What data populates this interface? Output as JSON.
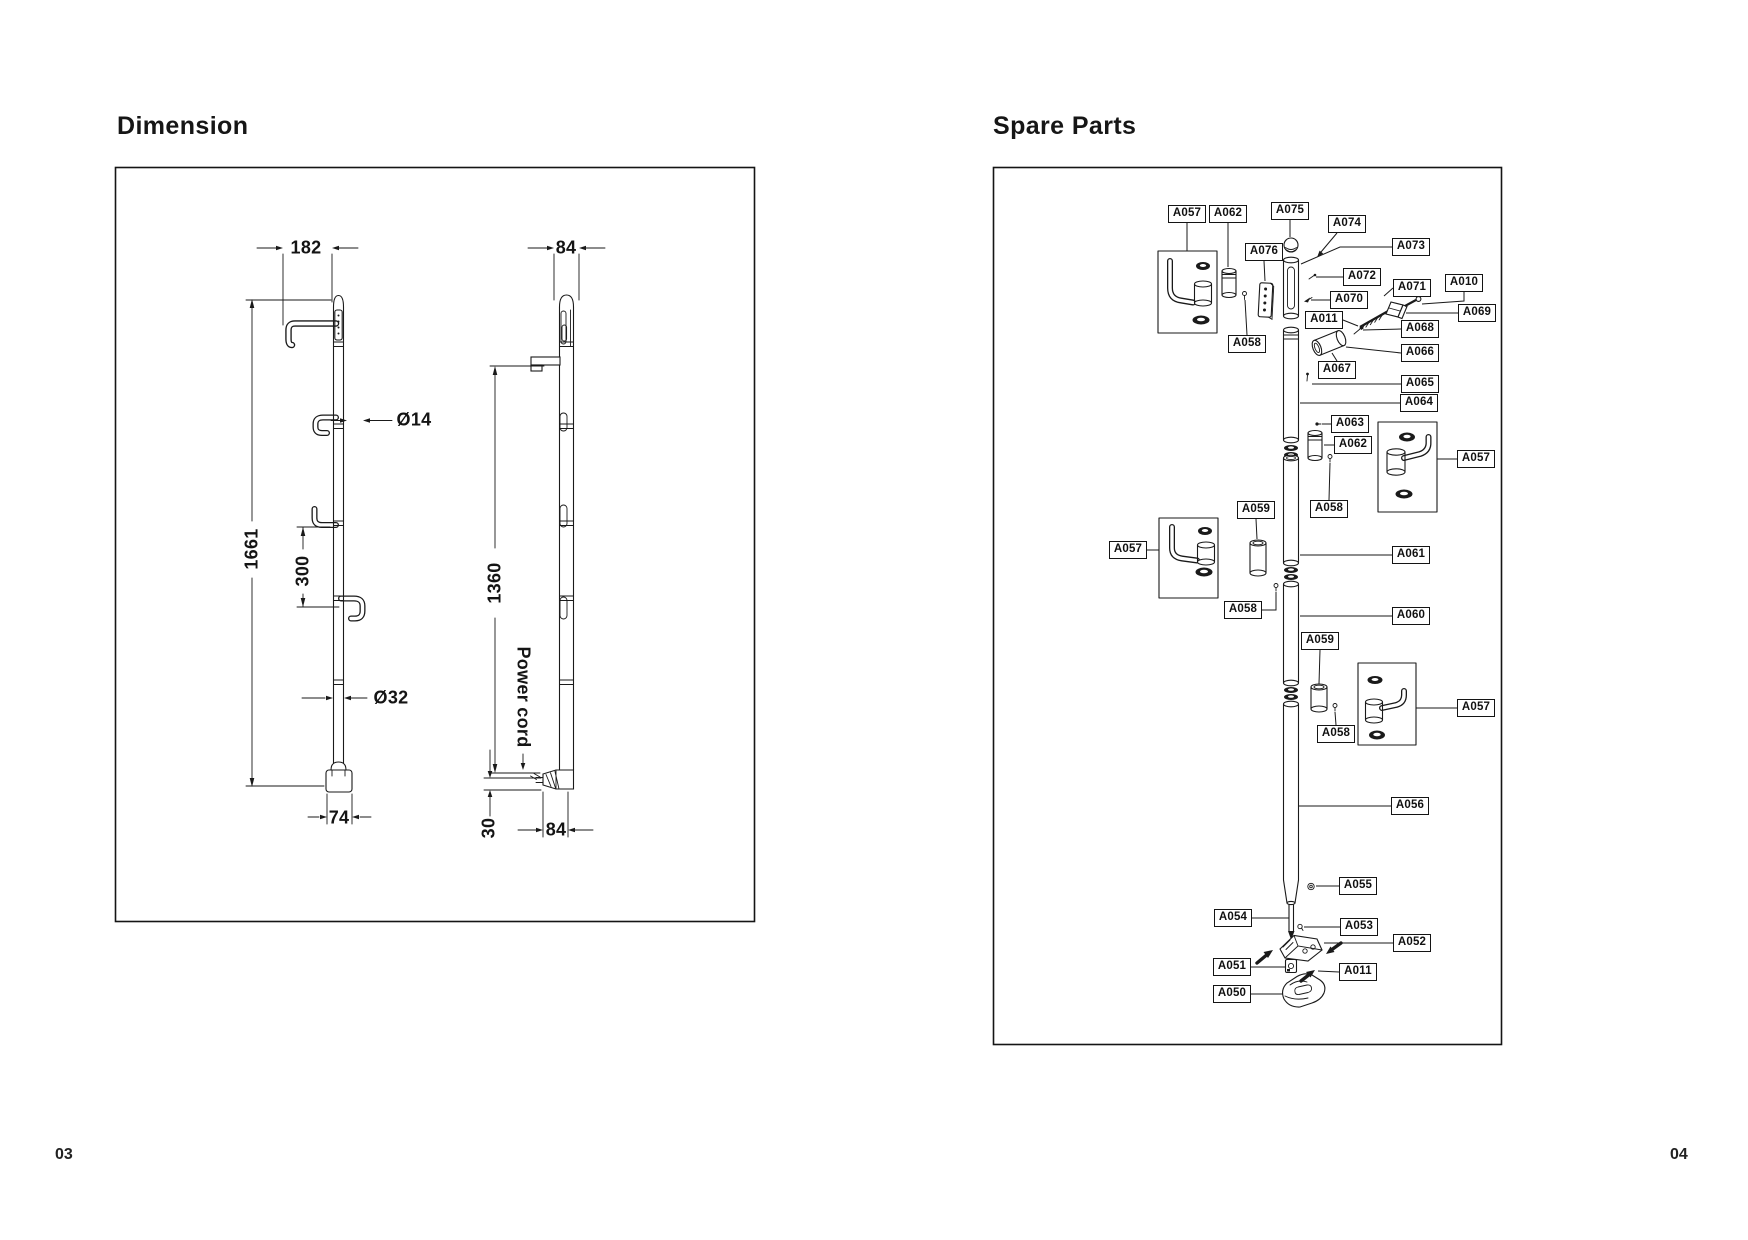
{
  "page": {
    "left_page_number": "03",
    "right_page_number": "04",
    "background": "#ffffff",
    "line_color": "#1a1a1a"
  },
  "dimension_panel": {
    "title": "Dimension",
    "front_view": {
      "top_width": "182",
      "hook_diameter": "Ø14",
      "total_height": "1661",
      "hook_spacing": "300",
      "pole_diameter": "Ø32",
      "base_width": "74"
    },
    "side_view": {
      "top_width": "84",
      "mount_height": "1360",
      "power_cord_label": "Power cord",
      "cord_offset": "30",
      "bottom_width": "84"
    }
  },
  "spare_parts_panel": {
    "title": "Spare Parts",
    "labels": [
      {
        "text": "A057",
        "x": 1168,
        "y": 205,
        "leader": [
          [
            1187,
            223
          ],
          [
            1187,
            251
          ]
        ]
      },
      {
        "text": "A062",
        "x": 1209,
        "y": 205,
        "leader": [
          [
            1228,
            223
          ],
          [
            1228,
            267
          ]
        ]
      },
      {
        "text": "A075",
        "x": 1271,
        "y": 202,
        "leader": [
          [
            1290,
            220
          ],
          [
            1290,
            237
          ]
        ]
      },
      {
        "text": "A074",
        "x": 1328,
        "y": 215,
        "leader": [
          [
            1337,
            233
          ],
          [
            1321,
            252
          ]
        ]
      },
      {
        "text": "A073",
        "x": 1392,
        "y": 238,
        "leader": [
          [
            1392,
            247
          ],
          [
            1340,
            247
          ],
          [
            1301,
            264
          ]
        ]
      },
      {
        "text": "A076",
        "x": 1245,
        "y": 243,
        "leader": [
          [
            1264,
            261
          ],
          [
            1265,
            281
          ]
        ]
      },
      {
        "text": "A072",
        "x": 1343,
        "y": 268,
        "leader": [
          [
            1343,
            277
          ],
          [
            1316,
            277
          ]
        ]
      },
      {
        "text": "A010",
        "x": 1445,
        "y": 274,
        "leader": [
          [
            1464,
            292
          ],
          [
            1464,
            301
          ],
          [
            1422,
            304
          ]
        ]
      },
      {
        "text": "A071",
        "x": 1393,
        "y": 279,
        "leader": [
          [
            1393,
            288
          ],
          [
            1384,
            296
          ]
        ]
      },
      {
        "text": "A070",
        "x": 1330,
        "y": 291,
        "leader": [
          [
            1330,
            300
          ],
          [
            1311,
            300
          ]
        ]
      },
      {
        "text": "A069",
        "x": 1458,
        "y": 304,
        "leader": [
          [
            1458,
            313
          ],
          [
            1406,
            313
          ]
        ]
      },
      {
        "text": "A011",
        "x": 1305,
        "y": 311,
        "leader": [
          [
            1343,
            320
          ],
          [
            1358,
            326
          ]
        ]
      },
      {
        "text": "A068",
        "x": 1401,
        "y": 320,
        "leader": [
          [
            1401,
            329
          ],
          [
            1363,
            330
          ]
        ]
      },
      {
        "text": "A066",
        "x": 1401,
        "y": 344,
        "leader": [
          [
            1401,
            353
          ],
          [
            1346,
            347
          ]
        ]
      },
      {
        "text": "A067",
        "x": 1318,
        "y": 361,
        "leader": [
          [
            1337,
            361
          ],
          [
            1332,
            353
          ]
        ]
      },
      {
        "text": "A058",
        "x": 1228,
        "y": 335,
        "leader": [
          [
            1247,
            335
          ],
          [
            1245,
            300
          ]
        ]
      },
      {
        "text": "A065",
        "x": 1401,
        "y": 375,
        "leader": [
          [
            1401,
            384
          ],
          [
            1312,
            384
          ]
        ]
      },
      {
        "text": "A064",
        "x": 1400,
        "y": 394,
        "leader": [
          [
            1400,
            403
          ],
          [
            1300,
            403
          ]
        ]
      },
      {
        "text": "A063",
        "x": 1331,
        "y": 415,
        "leader": [
          [
            1331,
            424
          ],
          [
            1322,
            424
          ]
        ]
      },
      {
        "text": "A062",
        "x": 1334,
        "y": 436,
        "leader": [
          [
            1334,
            445
          ],
          [
            1324,
            445
          ]
        ]
      },
      {
        "text": "A057",
        "x": 1457,
        "y": 450,
        "leader": [
          [
            1457,
            459
          ],
          [
            1437,
            459
          ]
        ]
      },
      {
        "text": "A059",
        "x": 1237,
        "y": 501,
        "leader": [
          [
            1256,
            519
          ],
          [
            1257,
            539
          ]
        ]
      },
      {
        "text": "A058",
        "x": 1310,
        "y": 500,
        "leader": [
          [
            1329,
            500
          ],
          [
            1330,
            463
          ]
        ]
      },
      {
        "text": "A057",
        "x": 1109,
        "y": 541,
        "leader": [
          [
            1147,
            550
          ],
          [
            1159,
            550
          ]
        ]
      },
      {
        "text": "A061",
        "x": 1392,
        "y": 546,
        "leader": [
          [
            1392,
            555
          ],
          [
            1300,
            555
          ]
        ]
      },
      {
        "text": "A058",
        "x": 1224,
        "y": 601,
        "leader": [
          [
            1261,
            610
          ],
          [
            1276,
            610
          ],
          [
            1276,
            592
          ]
        ]
      },
      {
        "text": "A060",
        "x": 1392,
        "y": 607,
        "leader": [
          [
            1392,
            616
          ],
          [
            1300,
            616
          ]
        ]
      },
      {
        "text": "A059",
        "x": 1301,
        "y": 632,
        "leader": [
          [
            1320,
            650
          ],
          [
            1319,
            684
          ]
        ]
      },
      {
        "text": "A057",
        "x": 1457,
        "y": 699,
        "leader": [
          [
            1457,
            708
          ],
          [
            1416,
            708
          ]
        ]
      },
      {
        "text": "A058",
        "x": 1317,
        "y": 725,
        "leader": [
          [
            1336,
            725
          ],
          [
            1335,
            712
          ]
        ]
      },
      {
        "text": "A056",
        "x": 1391,
        "y": 797,
        "leader": [
          [
            1391,
            806
          ],
          [
            1299,
            806
          ]
        ]
      },
      {
        "text": "A055",
        "x": 1339,
        "y": 877,
        "leader": [
          [
            1339,
            886
          ],
          [
            1316,
            886
          ]
        ]
      },
      {
        "text": "A054",
        "x": 1214,
        "y": 909,
        "leader": [
          [
            1252,
            918
          ],
          [
            1289,
            918
          ]
        ]
      },
      {
        "text": "A053",
        "x": 1340,
        "y": 918,
        "leader": [
          [
            1340,
            927
          ],
          [
            1304,
            927
          ]
        ]
      },
      {
        "text": "A052",
        "x": 1393,
        "y": 934,
        "leader": [
          [
            1393,
            943
          ],
          [
            1324,
            943
          ]
        ]
      },
      {
        "text": "A051",
        "x": 1213,
        "y": 958,
        "leader": [
          [
            1251,
            967
          ],
          [
            1285,
            967
          ]
        ]
      },
      {
        "text": "A011",
        "x": 1339,
        "y": 963,
        "leader": [
          [
            1339,
            972
          ],
          [
            1318,
            971
          ]
        ]
      },
      {
        "text": "A050",
        "x": 1213,
        "y": 985,
        "leader": [
          [
            1251,
            994
          ],
          [
            1283,
            994
          ]
        ]
      }
    ]
  }
}
